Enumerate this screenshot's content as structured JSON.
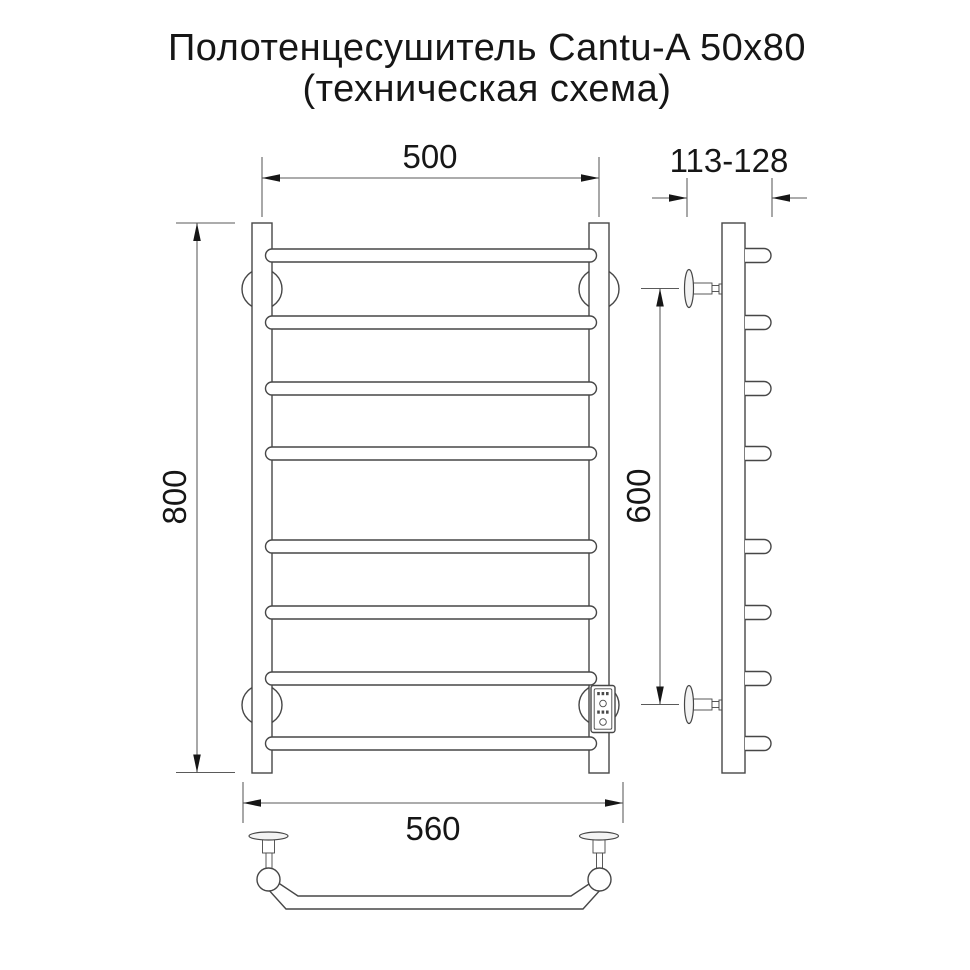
{
  "title": {
    "line1": "Полотенцесушитель Cantu-A 50x80",
    "line2": "(техническая схема)"
  },
  "dimensions": {
    "width_top": "500",
    "mount_depth": "113-128",
    "height": "800",
    "mount_height": "600",
    "width_bottom": "560"
  },
  "colors": {
    "background": "#ffffff",
    "line": "#474747",
    "dim-line": "#5a5a5a",
    "ink": "#161616"
  }
}
